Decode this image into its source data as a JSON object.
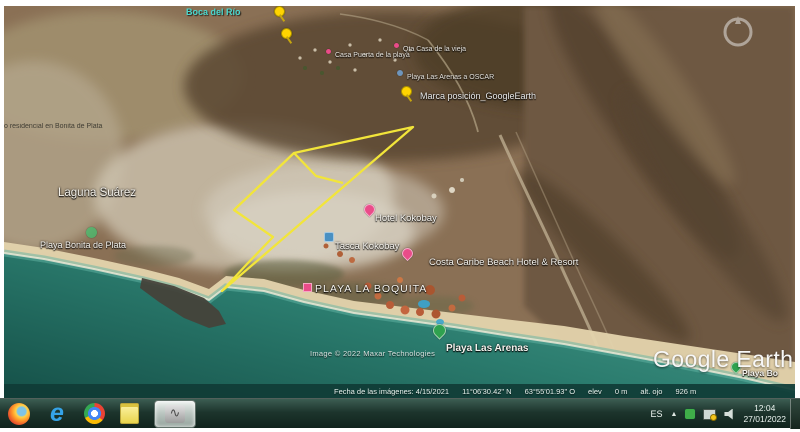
{
  "app": {
    "name": "Google Earth"
  },
  "map": {
    "labels": {
      "boca_rio": "Boca del Río",
      "residencial": "o residencial en Bonita de Plata",
      "laguna": "Laguna Suárez",
      "playa_bonita": "Playa Bonita de Plata",
      "casa_puerta": "Casa Puerta de la playa",
      "casa_vieja": "Qta Casa de la vieja",
      "arenas_oscar": "Playa Las Arenas a OSCAR",
      "marca_posicion": "Marca posición_GoogleEarth",
      "hotel_kokobay": "Hotel Kokobay",
      "tasca_kokobay": "Tasca Kokobay",
      "costa_caribe": "Costa Caribe Beach Hotel & Resort",
      "playa_boquita": "PLAYA LA BOQUITA",
      "playa_arenas": "Playa Las Arenas",
      "playa_bo": "Playa Bo",
      "attribution": "Image © 2022 Maxar Technologies",
      "logo": "Google Earth"
    },
    "icons": {
      "lodging_pin": "pink teardrop pin",
      "place_pin": "green teardrop pin",
      "user_pushpin": "yellow pushpin",
      "poi_pin": "blue square pin",
      "compass": "navigation ring"
    },
    "colors": {
      "property_polygon": "#f2e53a",
      "ocean": "#2b7c6e",
      "cyan_label": "#49d8cf"
    }
  },
  "statusbar": {
    "fecha": "Fecha de las imágenes: 4/15/2021",
    "lat": "11°06'30.42\" N",
    "lon": "63°55'01.93\" O",
    "elev_label": "elev",
    "elev_value": "0 m",
    "eye_label": "alt. ojo",
    "eye_value": "926 m"
  },
  "taskbar": {
    "language": "ES",
    "time": "12:04",
    "date": "27/01/2022",
    "icons": [
      "firefox",
      "internet-explorer",
      "chrome",
      "notes",
      "active-app",
      "hidden-icons",
      "antivirus",
      "network",
      "volume"
    ]
  }
}
